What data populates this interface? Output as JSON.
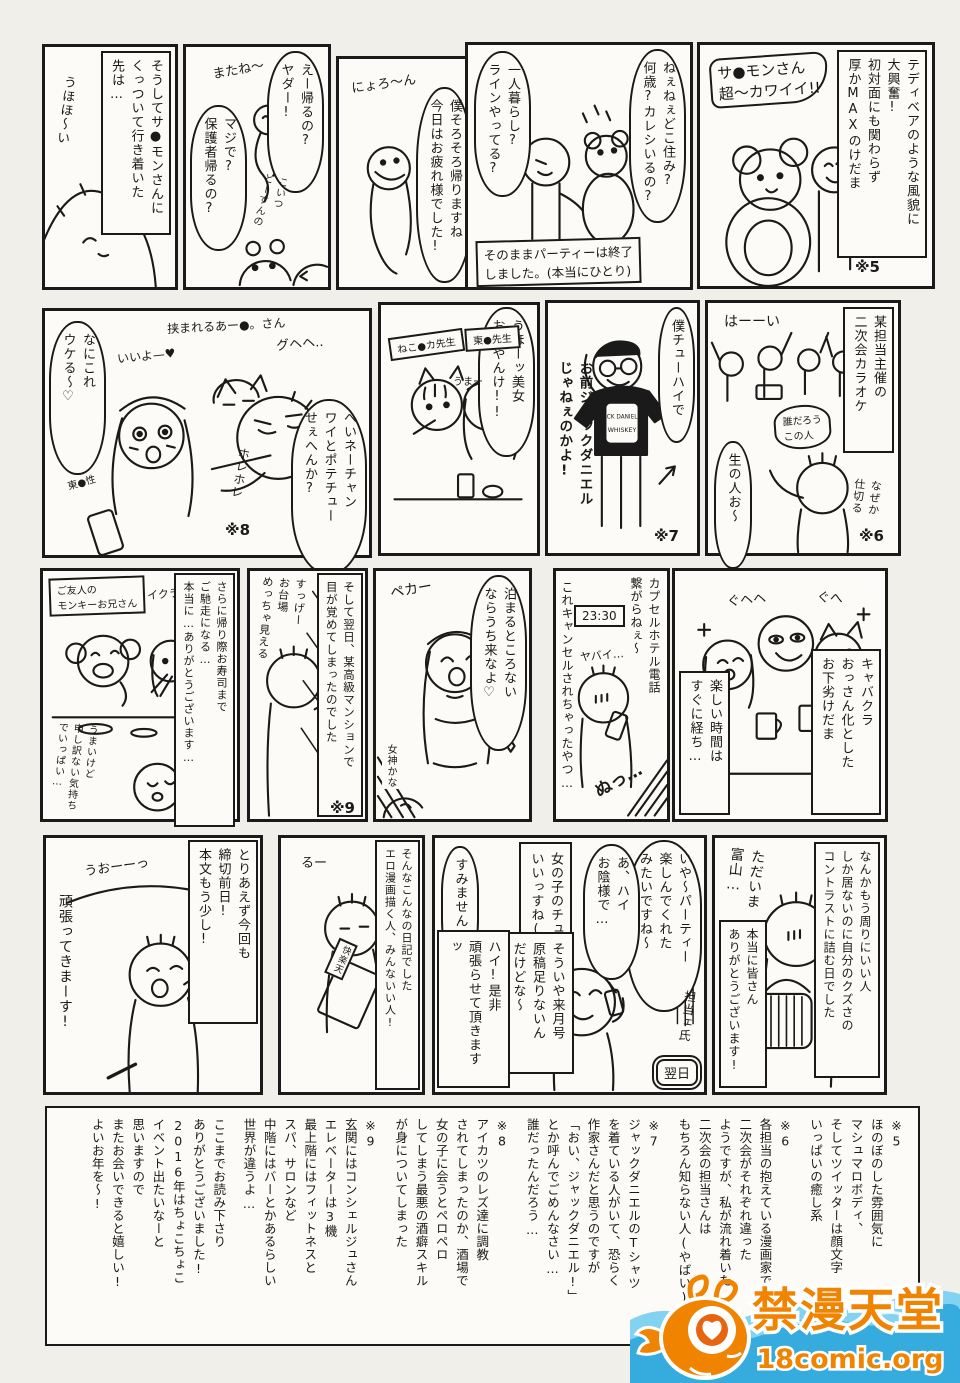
{
  "colors": {
    "ink": "#1a1a1a",
    "paper": "#f1efe9",
    "panel": "#fcfbf7",
    "wm_orange": "#f08300",
    "wm_orange_deep": "#e8650f",
    "wm_blue": "#36abdd",
    "wm_blue_light": "#82d2f2"
  },
  "panels": {
    "tagalong": {
      "narration": "そうしてサ●モンさんに\nくっついて行き着いた\n先は…",
      "sfx": "うほほ〜い"
    },
    "leaving": {
      "bubble_right": "えー帰るの?\nヤダー!",
      "sfx_matane": "またね〜",
      "bubble_left": "マジで?\n保護者帰るの?",
      "sfx_koitsu": "こいつ\nどーすんの"
    },
    "snake": {
      "sfx": "にょろ〜ん",
      "bubble": "僕そろそろ帰りますね\n今日はお疲れ様でした!"
    },
    "party_end": {
      "bubble_right": "ねぇねぇどこ住み?\n何歳?カレシいるの?",
      "bubble_left": "一人暮らし?\nラインやってる?",
      "caption": "そのままパーティーは終了\nしました。(本当にひとり)"
    },
    "teddy": {
      "narration": "テディベアのような風貌に\n大興奮!\n初対面にも関わらず\n厚かMAXのけだま",
      "bubble": "サ●モンさん\n超〜カワイイ!!",
      "note": "※5"
    },
    "potechu": {
      "caption": "挟まれるあー●。さん",
      "bubble_left": "なにこれ\nウケる〜♡",
      "sfx_iiyo": "いいよ—♥",
      "sfx_guhehe": "グヘヘ..",
      "label": "東●性",
      "sfx_horehore": "ホレホレ",
      "bubble_right": "へいネーチャン\nワイとポテチュー\nせぇへんか?",
      "note": "※8"
    },
    "beauties": {
      "bubble": "うほーッ美女\nおるやんけ!!",
      "label_neko": "ねこ●カ先生",
      "label_tou": "東●先生",
      "sfx": "うまー"
    },
    "jack_daniel": {
      "bubble": "僕チューハイで",
      "shout": "お前ジャックダニエル\nじゃねぇのかよ!",
      "shirt_line1": "JACK DANIEL'S",
      "shirt_line2": "WHISKEY",
      "note": "※7"
    },
    "karaoke": {
      "narration": "某担当主催の\n二次会カラオケ",
      "sfx_hai": "はーーい",
      "bubble_dare": "誰だろう\nこの人",
      "bubble_nama": "生の人お〜",
      "sfx_naze": "なぜか\n仕切る",
      "note": "※6"
    },
    "monkey": {
      "caption": "ご友人の\nモンキーお兄さん",
      "sfx_ikura": "イクラー♥",
      "narration": "さらに帰り際お寿司まで\nご馳走になる…\n本当に…ありがとうございます…",
      "hand": "うまいけど\n申し訳ない気持ち\nでいっぱい…"
    },
    "odaiba": {
      "hand": "すっげー\nお台場\nめっちゃ見える",
      "narration": "そして翌日、某高級マンションで\n目が覚めてしまったのでした",
      "note": "※9"
    },
    "goddess": {
      "bubble": "泊まるところない\nならうち来なよ♡",
      "sfx": "ペカー",
      "hand": "女神かな"
    },
    "capsule": {
      "narration_right": "カプセルホテル電話\n繋がらねぇ〜",
      "time": "23:30",
      "sfx_yabai": "ヤバイ…",
      "narration_left": "これキャンセルされちゃったやつ…",
      "sfx_nu": "ぬっ…"
    },
    "cabaret": {
      "narration_right": "キャバクラ\nおっさん化とした\nお下劣けだま",
      "narration_left": "楽しい時間は\nすぐに経ち…",
      "sfx1": "ぐヘヘ",
      "sfx2": "ぐへ"
    },
    "deadline": {
      "narration": "とりあえず今回も\n締切前日!\n本文もう少し!",
      "sfx": "うおーーっ",
      "bubble": "頑張ってきまーす!"
    },
    "diary_end": {
      "narration": "そんなこんなの日記でした\nエロ漫画描く人、みんないい人!",
      "sfx": "るー",
      "book": "快楽天"
    },
    "editor": {
      "bubble_party": "いや〜パーティー\n楽しんでくれた\nみたいですね〜",
      "bubble_okage": "あ、ハイ\nお陰様で…",
      "box_kiss": "女の子のチュー\nいいっすね(笑)",
      "bubble_sumi": "すみません…",
      "box_genkou": "そういや来月号\n原稿足りないん\nだけどな〜",
      "bubble_hai": "ハイ!是非\n頑張らせて頂きますッ",
      "label": "担当ェ氏",
      "day": "翌日"
    },
    "toyama": {
      "narration": "なんかもう周りにいい人\nしか居ないのに自分のクズさの\nコントラストに詰む日でした",
      "hand": "ただいま\n富山…",
      "box_thanks": "本当に皆さん\nありがとうございます!"
    }
  },
  "footnotes": {
    "f5": "※5\nほのぼのした雰囲気に\nマシュマロボディ、\nそしてツイッターは顔文字\nいっぱいの癒し系",
    "f6": "※6\n各担当の抱えている漫画家で\n二次会がそれぞれ違った\nようですが、私が流れ着いた\n二次会の担当さんは\nもちろん知らない人(やばい)",
    "f7": "※7\nジャックダニエルのTシャツ\nを着ている人がいて、恐らく\n作家さんだと思うのですが\n「おい、ジャックダニエル!」\nとか呼んでごめんなさい…\n誰だったんだろう…",
    "f8": "※8\nアイカツのレズ達に調教\nされてしまったのか、酒場で\n女の子に会うとペロペロ\nしてしまう最悪の酒癖スキル\nが身についてしまった",
    "f9": "※9\n玄関にはコンシェルジュさん\nエレベーターは3機\n最上階にはフィットネスと\nスパ、サロンなど\n中階にはバーとかあるらしい\n世界が違うよ…",
    "closing": "ここまでお読み下さり\nありがとうございました!\n2016年はちょこちょこ\nイベント出たいなーと\n思いますので\nまたお会いできると嬉しい!\nよいお年を〜!"
  },
  "watermark": {
    "site_name": "禁漫天堂",
    "site_url": "18comic.org"
  }
}
